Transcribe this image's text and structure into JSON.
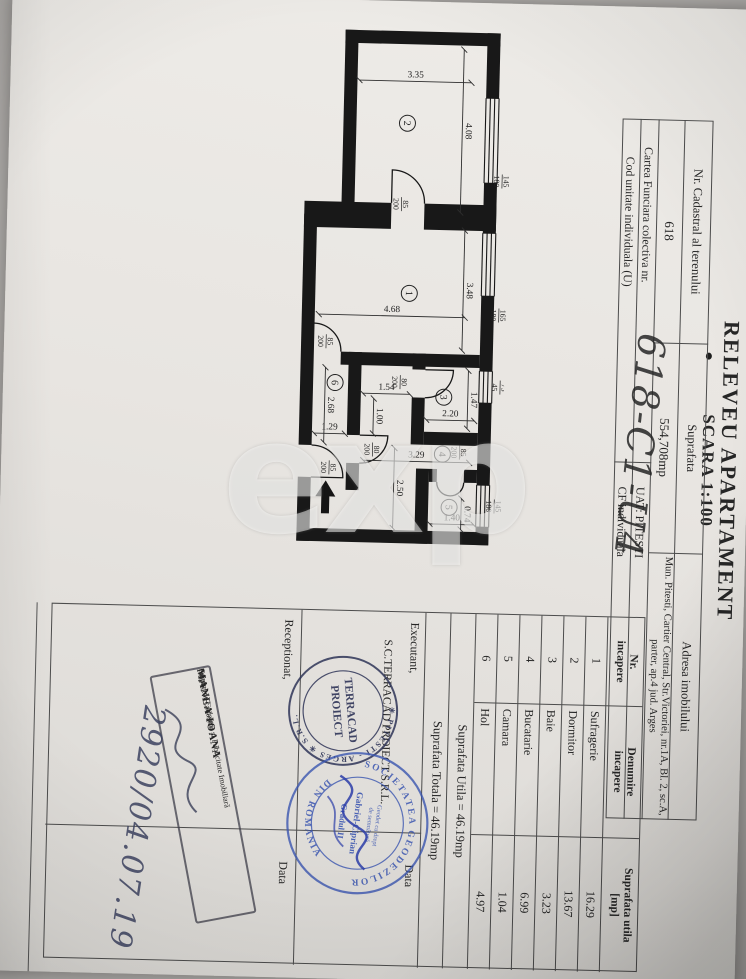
{
  "watermark": {
    "text": "exp"
  },
  "title": {
    "line1": "RELEVEU APARTAMENT",
    "line2": "SCARA 1:100"
  },
  "info_table": {
    "headers": {
      "col1": "Nr. Cadastral al terenului",
      "col2": "Suprafata",
      "col3": "Adresa imobilului"
    },
    "values": {
      "col1": "618",
      "col2": "554,708mp",
      "col3_line1": "Mun. Pitesti, Cartier Central, Str.Victoriei, nr.1A, Bl. 2, sc.A,",
      "col3_line2": "parter, ap.4 jud. Arges"
    },
    "row3": {
      "left": "Cartea Funciara colectiva nr.",
      "right": "UAT: PITESTI"
    },
    "row4": {
      "left": "Cod unitate individuala (U)",
      "right": "CF individuala"
    },
    "handwritten_code": "618-C1-U4"
  },
  "room_table": {
    "header": {
      "col1_line1": "Nr.",
      "col1_line2": "incapere",
      "col2_line1": "Denumire",
      "col2_line2": "incapere",
      "col3_line1": "Suprafata utila",
      "col3_line2": "[mp]"
    },
    "rows": [
      [
        "1",
        "Sufragerie",
        "16.29"
      ],
      [
        "2",
        "Dormitor",
        "13.67"
      ],
      [
        "3",
        "Baie",
        "3.23"
      ],
      [
        "4",
        "Bucatarie",
        "6.99"
      ],
      [
        "5",
        "Camara",
        "1.04"
      ],
      [
        "6",
        "Hol",
        "4.97"
      ]
    ],
    "total_utila": "Suprafata Utila = 46.19mp",
    "total_totala": "Suprafata Totala = 46.19mp"
  },
  "signatures": {
    "executant_label": "Executant,",
    "executant_name": "S.C.TERRACAD PROIECT S.R.L.",
    "executant_data_label": "Data",
    "receptionat_label": "Receptionat,",
    "receptionat_data_label": "Data",
    "handwritten_date": "2920/04.07.19"
  },
  "stamps": {
    "terracad_round": {
      "ring_text": "✳ PITESTI - ARGES ✳ S.R.L.",
      "center_line1": "TERRACAD",
      "center_line2": "PROIECT"
    },
    "geodez_round": {
      "ring_top": "SOCIETATEA GEODEZILOR",
      "ring_bottom": "DIN ROMANIA",
      "center_lines": [
        "Geodet cu drept",
        "de semnătură",
        "Gabriel-Ciprian",
        "Gradul II"
      ]
    },
    "ocpi_rect": {
      "line1": "Oficiul de Cadastru și Publicitate Imobiliară",
      "line2": "Argeș",
      "line3": "MANEA IOANA",
      "line4": "Inspector cadastru"
    }
  },
  "plan": {
    "window_band": [
      257,
      270
    ],
    "walls": [
      [
        30,
        257,
        65,
        13
      ],
      [
        180,
        257,
        50,
        13
      ],
      [
        293,
        257,
        75,
        13
      ],
      [
        400,
        257,
        82,
        13
      ],
      [
        524,
        257,
        18,
        13
      ],
      [
        30,
        257,
        13,
        155
      ],
      [
        30,
        399,
        185,
        13
      ],
      [
        202,
        257,
        26,
        72
      ],
      [
        202,
        362,
        26,
        87
      ],
      [
        529,
        257,
        13,
        192
      ],
      [
        215,
        436,
        231,
        13
      ],
      [
        478,
        436,
        64,
        13
      ],
      [
        352,
        270,
        13,
        139
      ],
      [
        352,
        324,
        16,
        13
      ],
      [
        396,
        324,
        47,
        13
      ],
      [
        430,
        270,
        13,
        54
      ],
      [
        352,
        388,
        83,
        13
      ],
      [
        463,
        388,
        27,
        13
      ],
      [
        467,
        270,
        13,
        13
      ],
      [
        467,
        310,
        13,
        8
      ],
      [
        467,
        318,
        75,
        13
      ]
    ],
    "windows": [
      {
        "x1": 95,
        "x2": 180
      },
      {
        "x1": 230,
        "x2": 293
      },
      {
        "x1": 368,
        "x2": 400
      },
      {
        "x1": 482,
        "x2": 524
      }
    ],
    "doors": [
      "M202,362 L169,362 A33,33 0 0 1 202,329",
      "M352,437 L324,437 A28,28 0 0 1 352,409",
      "M368,324 L368,296 A28,28 0 0 1 396,324",
      "M435,388 L435,360 A28,28 0 0 1 463,388",
      "M478,436 L478,404 A32,32 0 0 0 446,436",
      "M480,283 A13.5,13.5 0 0 1 493.5,296.5 M480,310 A13.5,13.5 0 0 0 493.5,296.5"
    ],
    "dims": [
      {
        "l": "3.35",
        "x1": 80,
        "y1": 285,
        "x2": 80,
        "y2": 397,
        "r": 1
      },
      {
        "l": "4.08",
        "x1": 47,
        "y1": 293,
        "x2": 210,
        "y2": 293
      },
      {
        "l": "4.68",
        "x1": 315,
        "y1": 286,
        "x2": 315,
        "y2": 432,
        "r": 1
      },
      {
        "l": "3.48",
        "x1": 228,
        "y1": 288,
        "x2": 348,
        "y2": 288
      },
      {
        "l": "1.47",
        "x1": 368,
        "y1": 281,
        "x2": 426,
        "y2": 281
      },
      {
        "l": "2.20",
        "x1": 418,
        "y1": 274,
        "x2": 418,
        "y2": 322,
        "r": 1
      },
      {
        "l": "1.54",
        "x1": 393,
        "y1": 339,
        "x2": 393,
        "y2": 386,
        "r": 1
      },
      {
        "l": "1.00",
        "x1": 398,
        "y1": 375,
        "x2": 433,
        "y2": 375
      },
      {
        "l": "2.68",
        "x1": 368,
        "y1": 424,
        "x2": 443,
        "y2": 424
      },
      {
        "l": "1.29",
        "x1": 434,
        "y1": 403,
        "x2": 434,
        "y2": 434,
        "r": 1
      },
      {
        "l": "3.29",
        "x1": 460,
        "y1": 278,
        "x2": 460,
        "y2": 384,
        "r": 1
      },
      {
        "l": "2.50",
        "x1": 447,
        "y1": 353,
        "x2": 527,
        "y2": 353
      },
      {
        "l": "0.74",
        "x1": 496,
        "y1": 285,
        "x2": 527,
        "y2": 285
      },
      {
        "l": "1.40",
        "x1": 522,
        "y1": 272,
        "x2": 522,
        "y2": 316,
        "r": 1
      }
    ],
    "fractions": [
      {
        "t": "85",
        "b": "200",
        "x": 203,
        "y": 352
      },
      {
        "t": "85",
        "b": "200",
        "x": 342,
        "y": 424
      },
      {
        "t": "80",
        "b": "200",
        "x": 381,
        "y": 349
      },
      {
        "t": "80",
        "b": "200",
        "x": 449,
        "y": 375
      },
      {
        "t": "85",
        "b": "200",
        "x": 468,
        "y": 418
      },
      {
        "t": "85",
        "b": "200",
        "x": 450,
        "y": 288
      },
      {
        "t": "145",
        "b": "180",
        "x": 178,
        "y": 252
      },
      {
        "t": "165",
        "b": "180",
        "x": 312,
        "y": 252
      },
      {
        "t": "75",
        "b": "45",
        "x": 384,
        "y": 249
      },
      {
        "t": "145",
        "b": "180",
        "x": 503,
        "y": 252
      }
    ],
    "rooms": [
      {
        "n": "1",
        "x": 292,
        "y": 342
      },
      {
        "n": "2",
        "x": 122,
        "y": 348
      },
      {
        "n": "3",
        "x": 395,
        "y": 305
      },
      {
        "n": "4",
        "x": 452,
        "y": 305
      },
      {
        "n": "5",
        "x": 505,
        "y": 297
      },
      {
        "n": "6",
        "x": 383,
        "y": 414
      }
    ],
    "entrance_arrow": "M481,421 L497,411 L497,417 L514,417 L514,425 L497,425 L497,431 Z"
  }
}
